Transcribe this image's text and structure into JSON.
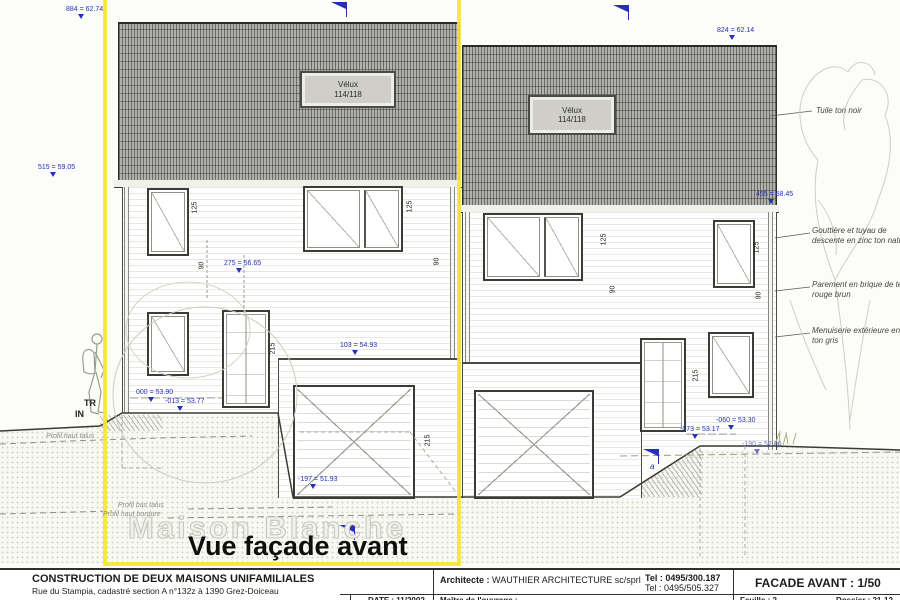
{
  "colors": {
    "accent_yellow": "#f4e738",
    "dimension_blue": "#2431b5",
    "ink": "#2f2f2b",
    "roof_gray": "#b1b1ae"
  },
  "captions": {
    "watermark": "Maison Blanche",
    "view_title": "Vue façade avant"
  },
  "velux": {
    "line1": "Vélux",
    "line2": "114/118"
  },
  "levels": [
    {
      "text": "884 = 62.74"
    },
    {
      "text": "824 = 62.14"
    },
    {
      "text": "515 = 59.05"
    },
    {
      "text": "455 = 58.45"
    },
    {
      "text": "275 = 56.65"
    },
    {
      "text": "103 = 54.93"
    },
    {
      "text": "000 = 53.90"
    },
    {
      "text": "-013 = 53.77"
    },
    {
      "text": "-197 = 51.93"
    },
    {
      "text": "-060 = 53.30"
    },
    {
      "text": "-073 = 53.17"
    },
    {
      "text": "-190 = 52.00"
    }
  ],
  "dims": [
    {
      "text": "125"
    },
    {
      "text": "90"
    },
    {
      "text": "125"
    },
    {
      "text": "90"
    },
    {
      "text": "215"
    },
    {
      "text": "215"
    },
    {
      "text": "125"
    },
    {
      "text": "90"
    },
    {
      "text": "125"
    },
    {
      "text": "90"
    },
    {
      "text": "215"
    }
  ],
  "annotations": [
    {
      "text": "Tuile ton noir"
    },
    {
      "text": "Gouttière et tuyau de\ndescente en zinc ton naturel"
    },
    {
      "text": "Parement en brique de teinte\nrouge brun"
    },
    {
      "text": "Menuiserie extérieure en pvc\nton gris"
    }
  ],
  "profiles": [
    {
      "text": "Profil haut talus"
    },
    {
      "text": "Profil bas talus"
    },
    {
      "text": "Profil haut bordure"
    }
  ],
  "site": {
    "tr": "TR",
    "in": "IN",
    "a_marker": "a"
  },
  "title_block": {
    "project": "CONSTRUCTION DE DEUX MAISONS UNIFAMILIALES",
    "address": "Rue du Stampia, cadastré section A n°132z à 1390 Grez-Doiceau",
    "architect_label": "Architecte :",
    "architect_name": "WAUTHIER ARCHITECTURE sc/sprl",
    "tel1": "Tel : 0495/300.187",
    "tel2": "Tel : 0495/505.327",
    "drawing_title": "FACADE AVANT : 1/50",
    "date": "DATE : 11/2002",
    "client_label": "Maître de l'ouvrage :",
    "sheet": "Feuille : 2",
    "dossier": "Dossier : 21-12"
  }
}
